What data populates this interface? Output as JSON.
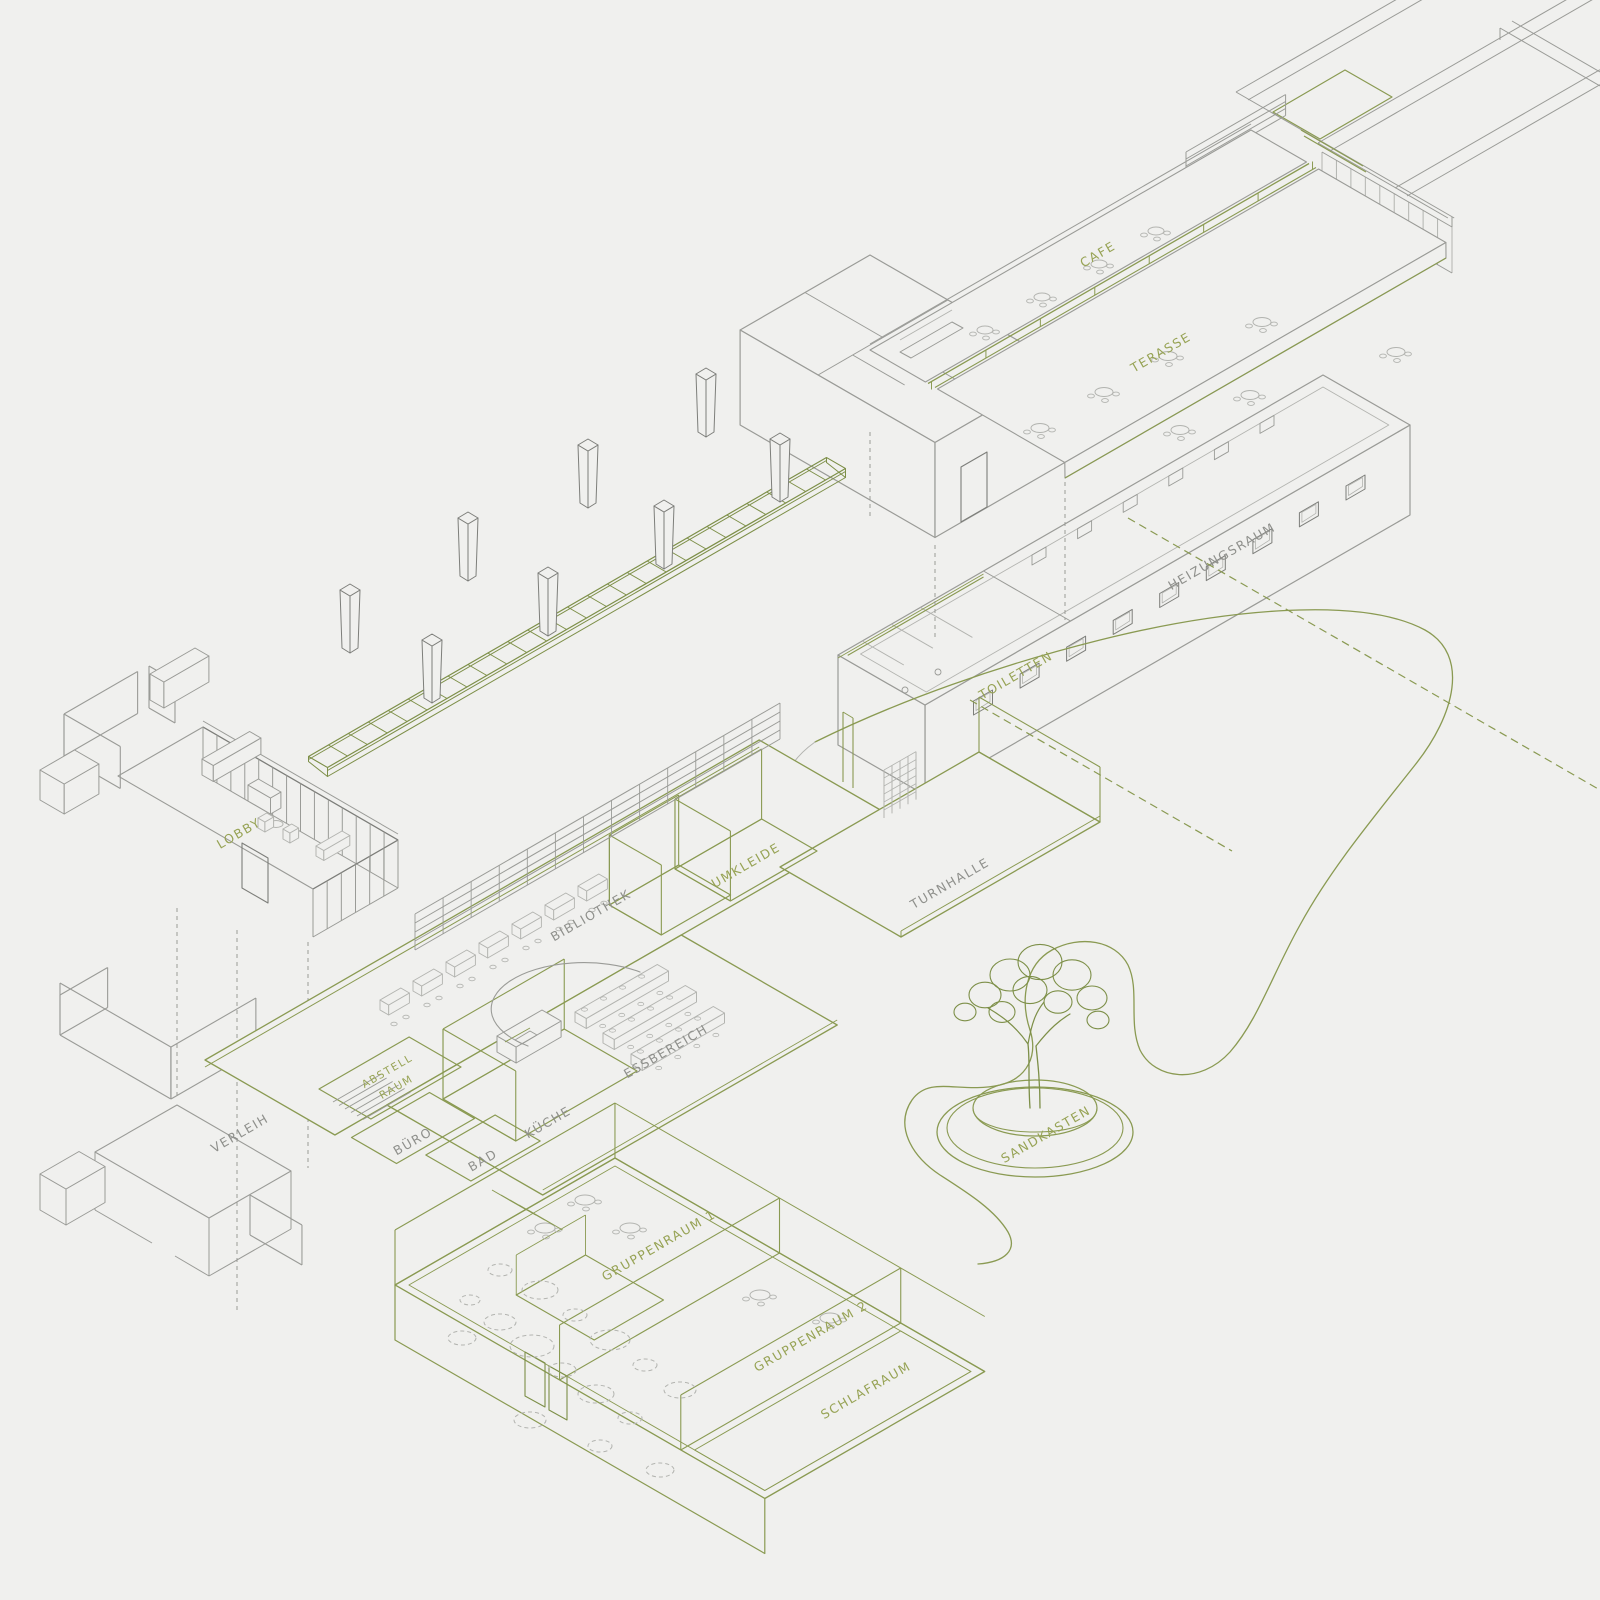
{
  "drawing": {
    "type": "exploded-axonometric-architecture-diagram",
    "palette": {
      "background": "#f0f0ee",
      "line_gray_light": "#b3b4b0",
      "line_gray": "#9a9b97",
      "line_gray_dark": "#7d7e7a",
      "line_green": "#8a9a52",
      "line_green_dark": "#7d8f48",
      "label_green": "#97a355",
      "label_gray": "#8f908c"
    },
    "labels": {
      "cafe": "CAFE",
      "terasse": "TERASSE",
      "heizungsraum": "HEIZUNGSRAUM",
      "toiletten": "TOILETTEN",
      "lobby": "LOBBY",
      "verleih": "VERLEIH",
      "bibliothek": "BIBLIOTHEK",
      "umkleide": "UMKLEIDE",
      "turnhalle": "TURNHALLE",
      "essbereich": "ESSBEREICH",
      "abstellraum_line1": "ABSTELL",
      "abstellraum_line2": "RAUM",
      "buero": "BÜRO",
      "bad": "BAD",
      "kueche": "KÜCHE",
      "gruppenraum1": "GRUPPENRAUM 1",
      "gruppenraum2": "GRUPPENRAUM 2",
      "schlafraum": "SCHLAFRAUM",
      "sandkasten": "SANDKASTEN"
    }
  }
}
